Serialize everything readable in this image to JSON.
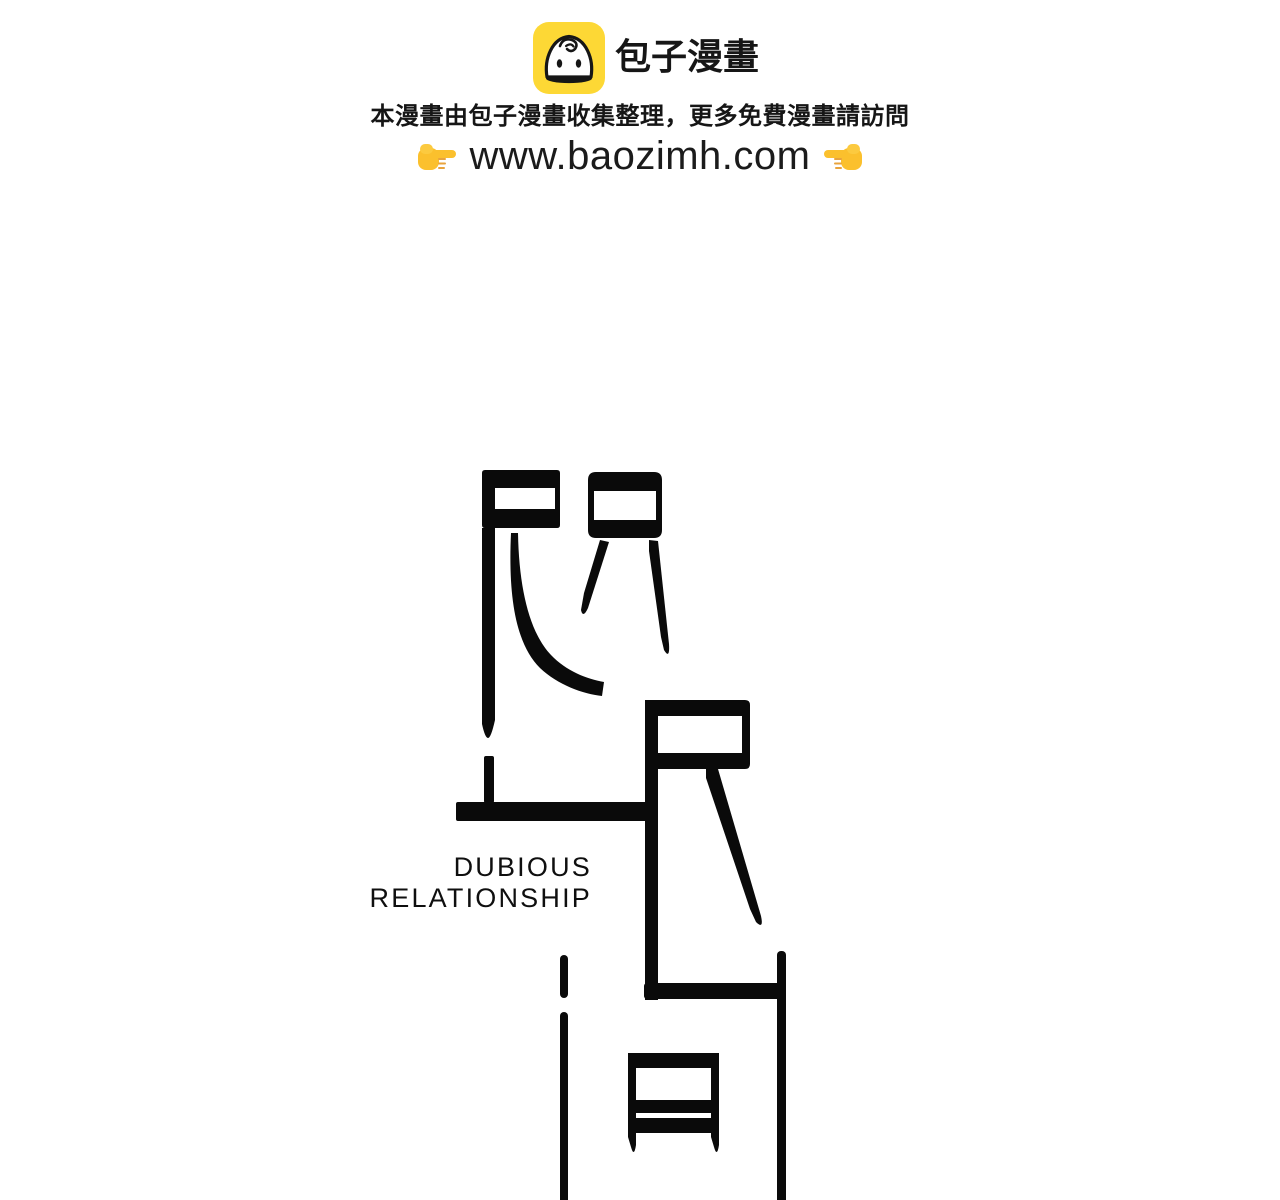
{
  "page": {
    "background": "#ffffff",
    "ink_color": "#0a0a0a"
  },
  "header": {
    "site_name": "包子漫畫",
    "logo_icon": "baozi-bun-face",
    "logo_color": "#FDD835",
    "notice": "本漫畫由包子漫畫收集整理，更多免費漫畫請訪問",
    "url": "www.baozimh.com",
    "pointer_icons": [
      "right-pointing-hand",
      "left-pointing-hand"
    ],
    "hand_color": "#FBC02D"
  },
  "artwork": {
    "type": "stylized-chinese-title-calligraphy",
    "english_title_line1": "DUBIOUS",
    "english_title_line2": "RELATIONSHIP"
  }
}
